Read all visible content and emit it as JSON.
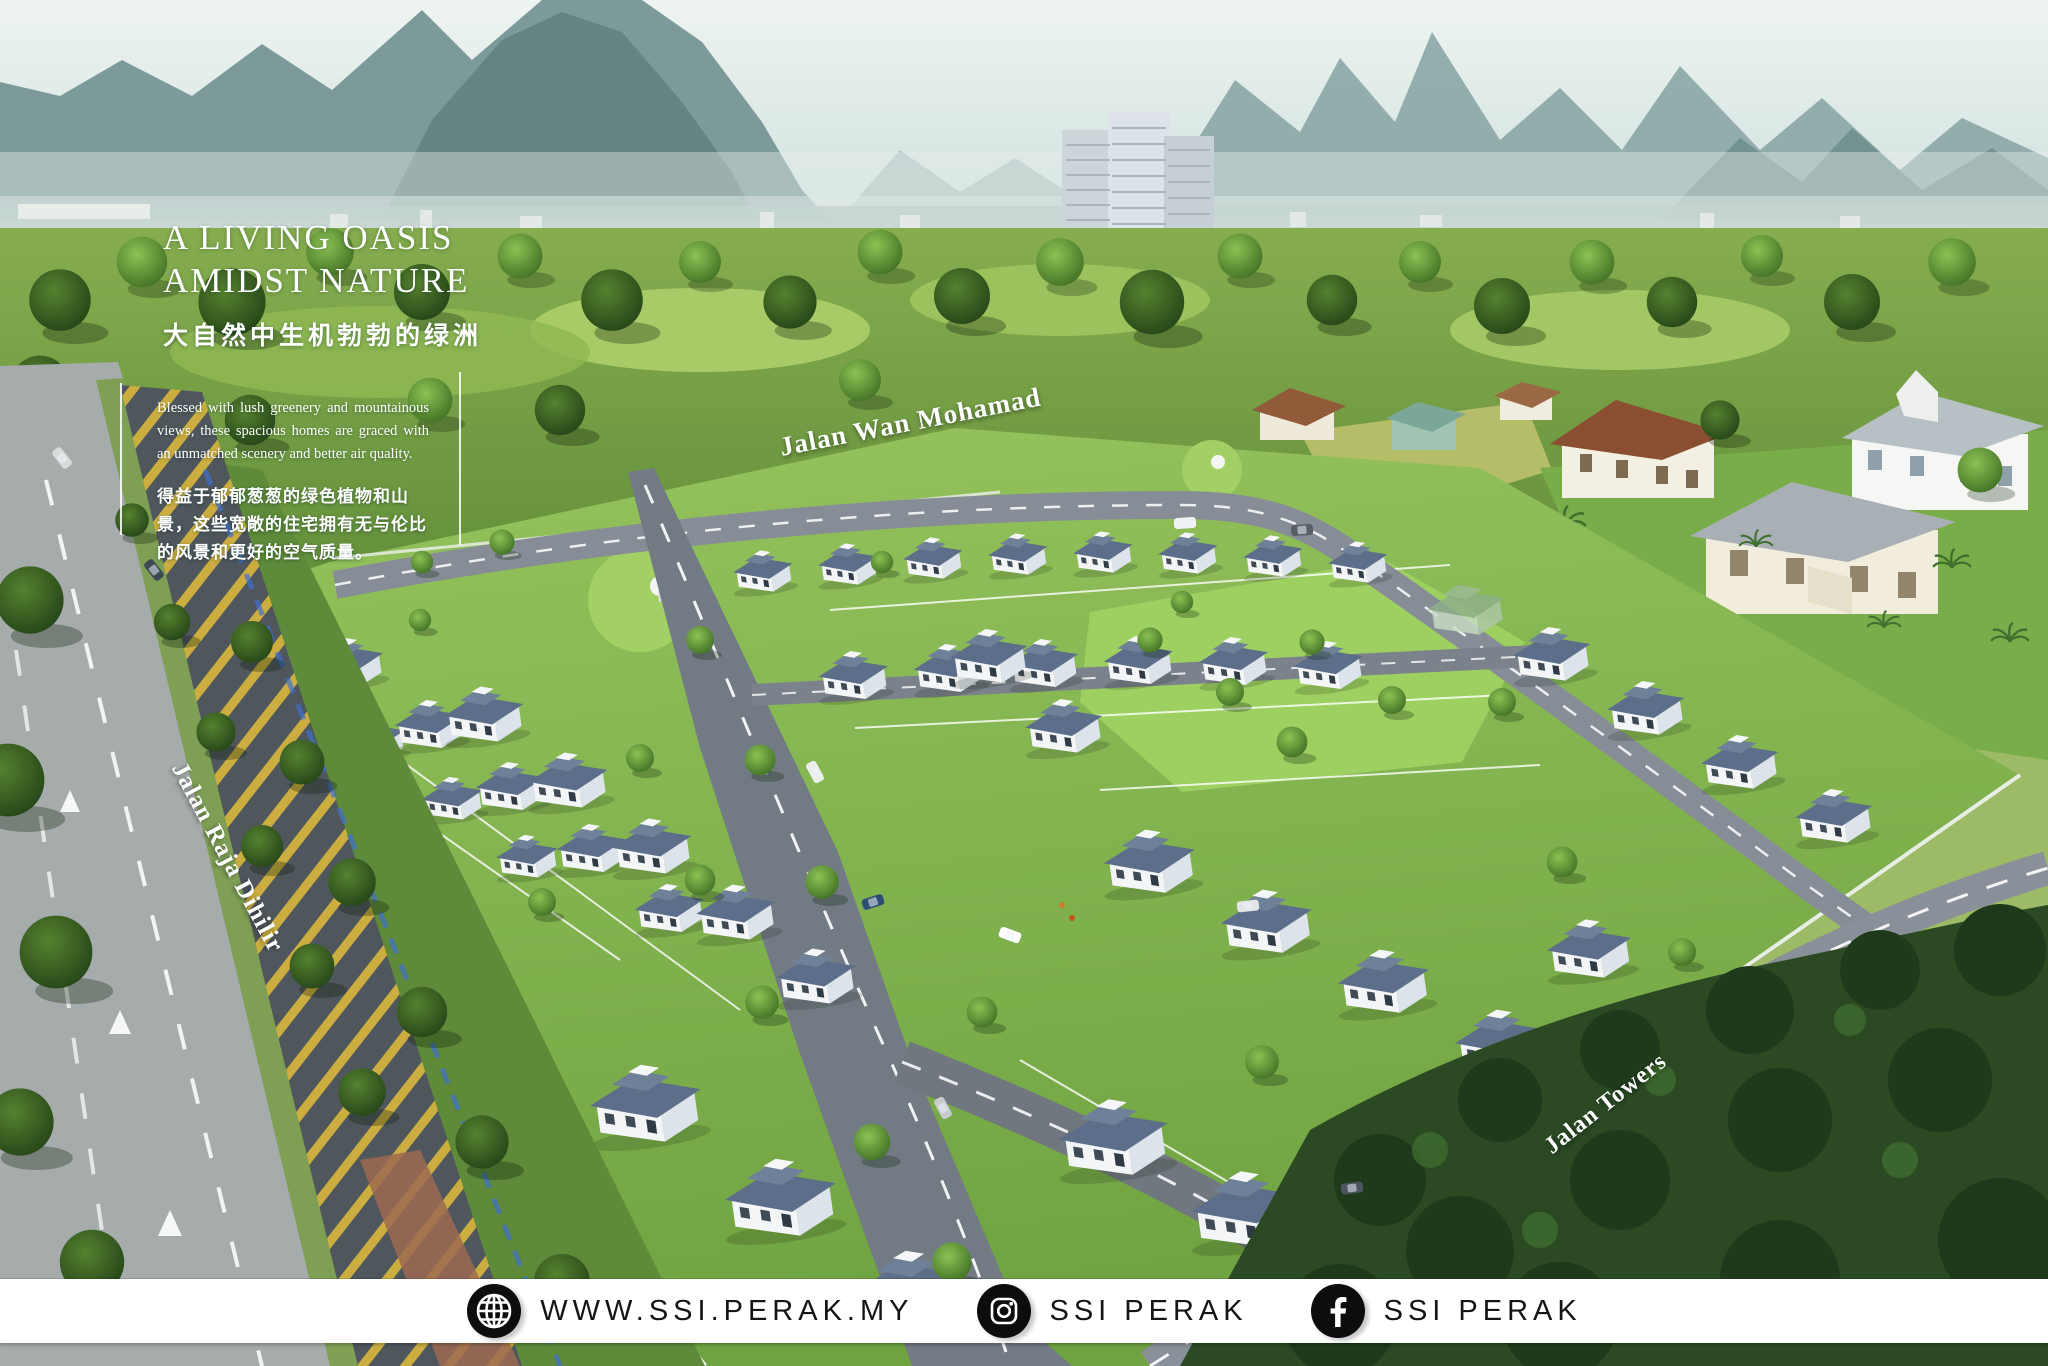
{
  "hero": {
    "title_line1": "A LIVING OASIS",
    "title_line2": "AMIDST NATURE",
    "subtitle_zh": "大自然中生机勃勃的绿洲",
    "paragraph_en": "Blessed with lush greenery and mountainous views, these spacious homes are graced with an unmatched scenery and better air quality.",
    "paragraph_zh": "得益于郁郁葱葱的绿色植物和山景，这些宽敞的住宅拥有无与伦比的风景和更好的空气质量。"
  },
  "road_labels": {
    "top_road": "Jalan Wan Mohamad",
    "left_road": "Jalan Raja Dihilir",
    "bottom_road": "Jalan Towers"
  },
  "footer": {
    "website_label": "WWW.SSI.PERAK.MY",
    "instagram_label": "SSI PERAK",
    "facebook_label": "SSI PERAK"
  },
  "colors": {
    "sky": "#e6efec",
    "mountain": "#7d9a9a",
    "estate_grass": "#8abc54",
    "roof_slate": "#5c6e89",
    "road_gray": "#7b828c",
    "forest_dark": "#2b4a24",
    "hatch_yellow": "#d7b53e",
    "footer_bg": "#ffffff",
    "footer_text": "#151515",
    "overlay_text": "#ffffff"
  }
}
